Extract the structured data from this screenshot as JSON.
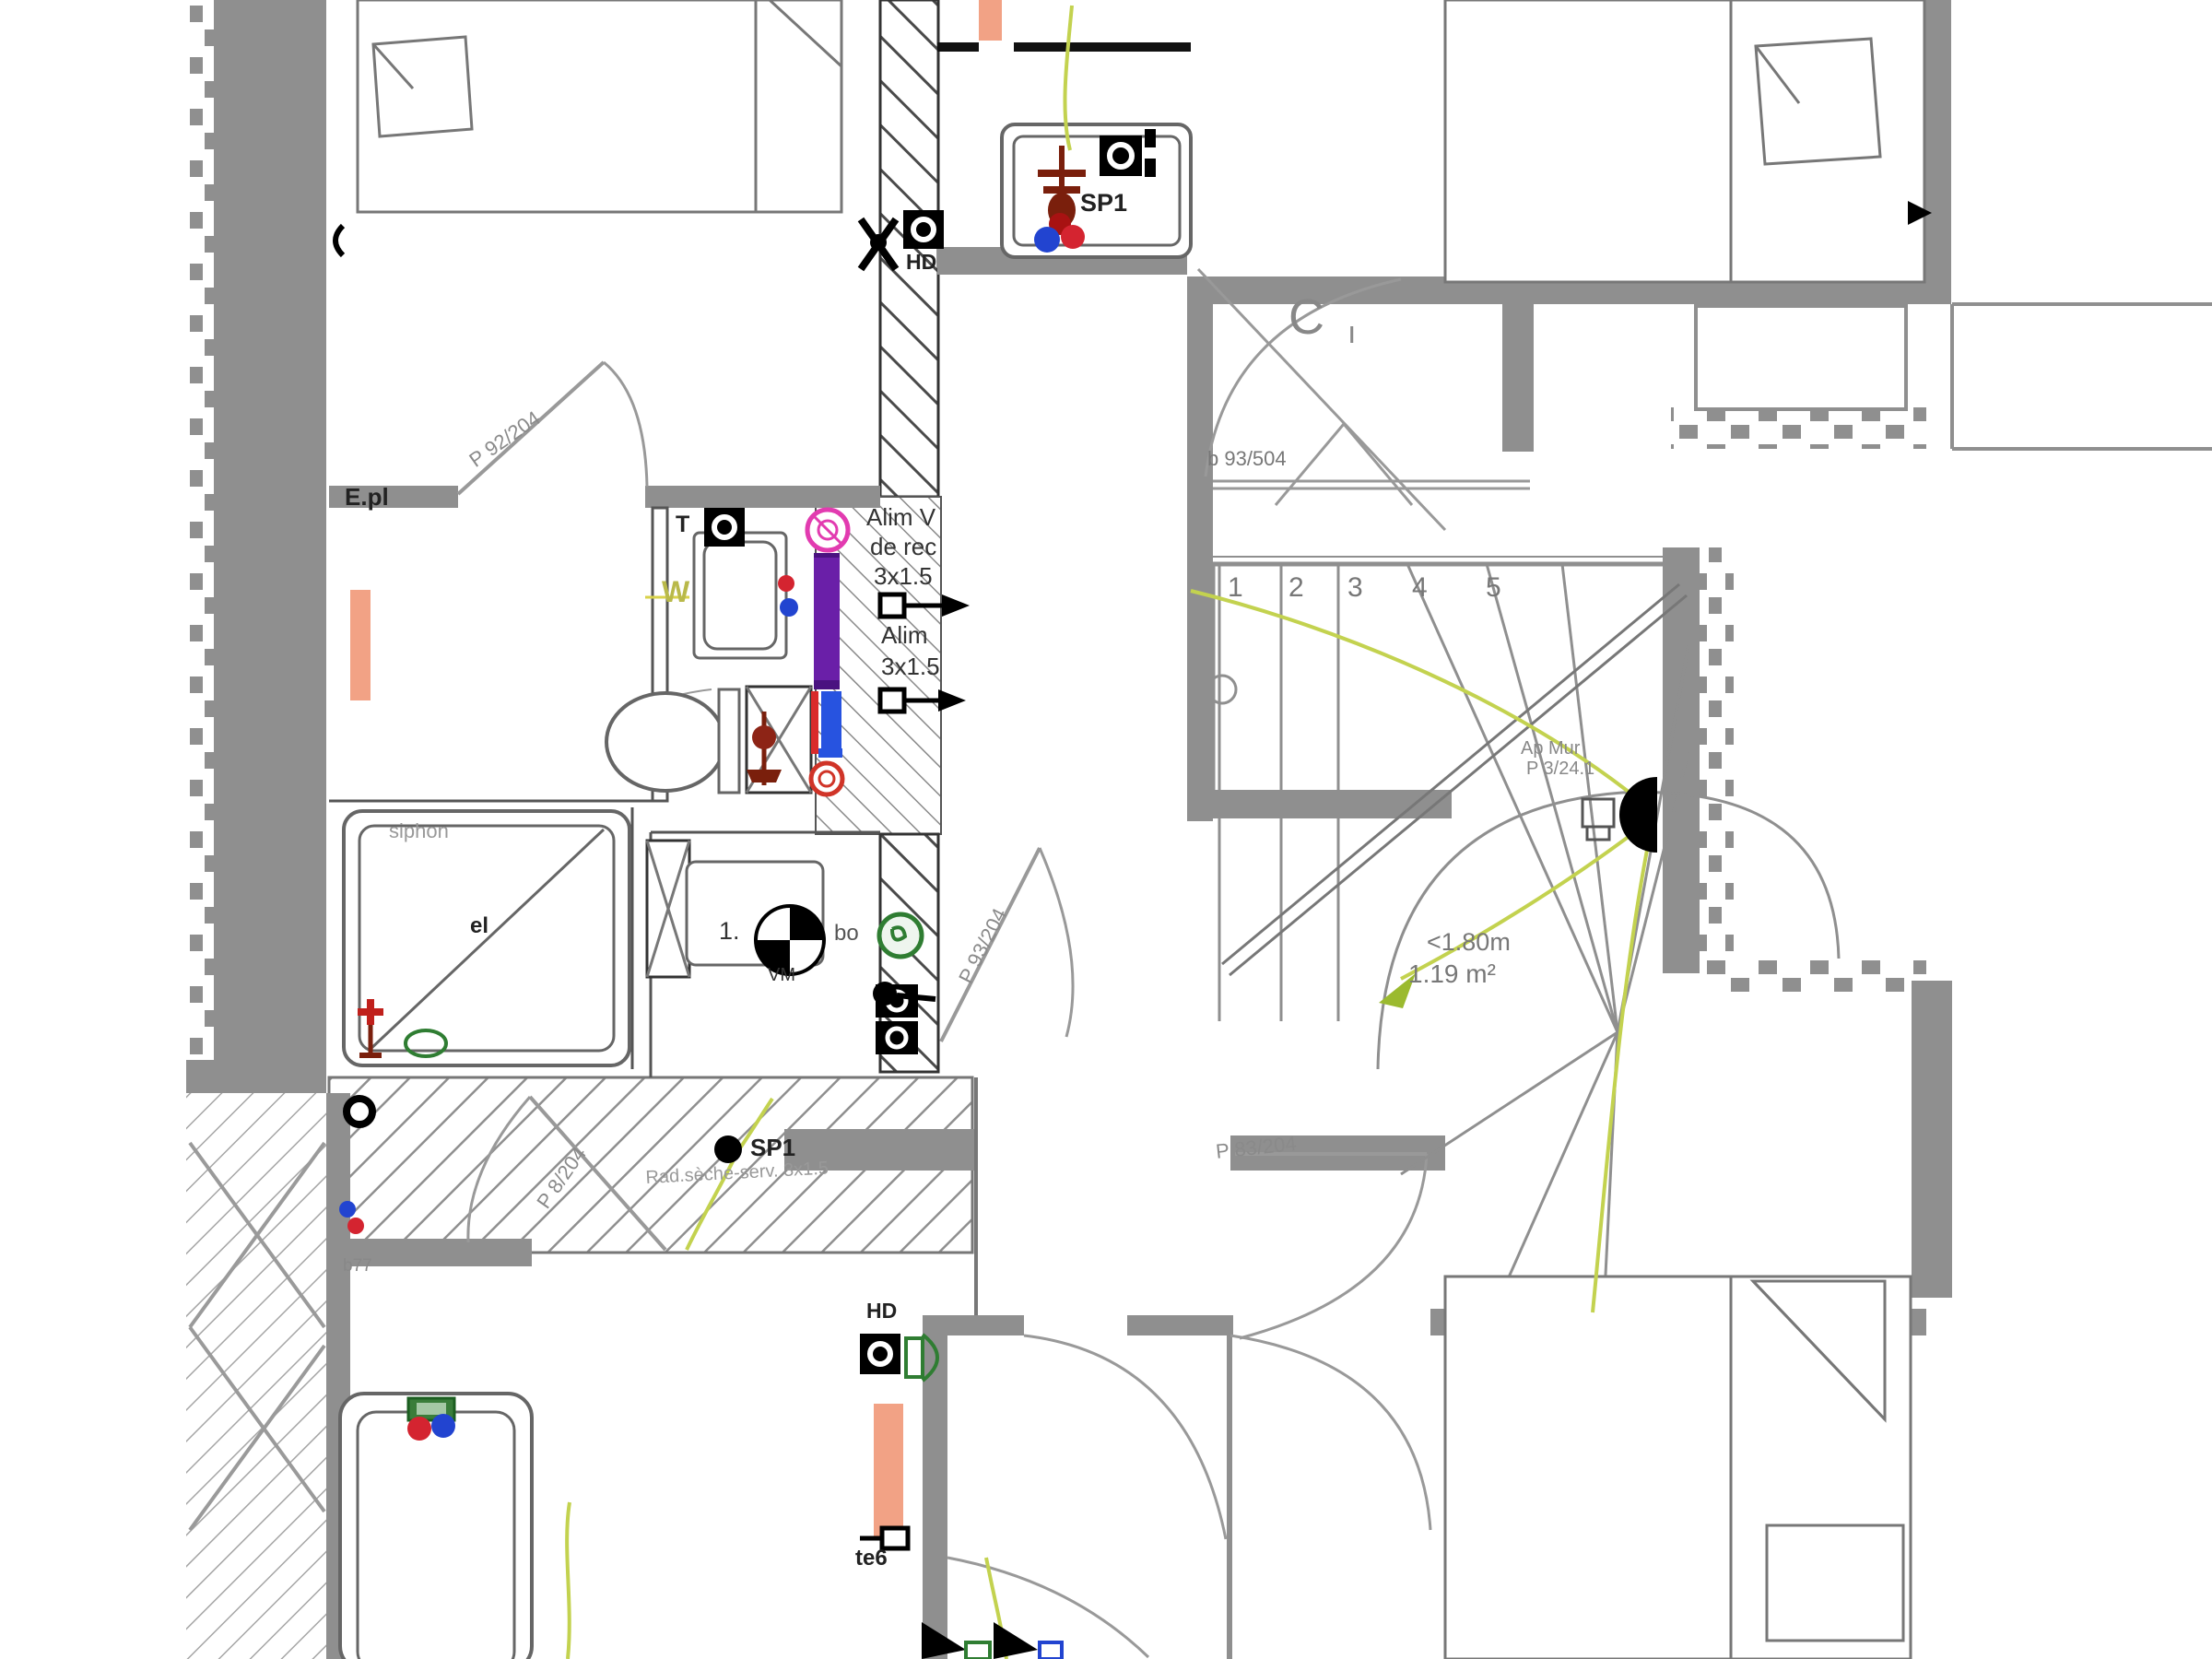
{
  "colors": {
    "wall": "#8f8f8f",
    "thin": "#6f6f6f",
    "line": "#9a9a9a",
    "radiator": "#f2a285",
    "cable": "#c3d24f",
    "purple": "#6a1fa8",
    "bluepipe": "#2753e0",
    "redpipe": "#d92b2b",
    "hot": "#d42430",
    "cold": "#2244d0",
    "magenta": "#e23bb0",
    "darkred": "#7a1f0c",
    "green": "#2f7d32",
    "label": "#8a8a8a"
  },
  "texts": {
    "sp1_top": "SP1",
    "hd_top": "HD",
    "alim1_l1": "Alim V",
    "alim1_l2": "de rec",
    "alim1_l3": "3x1.5",
    "alim2_l1": "Alim",
    "alim2_l2": "3x1.5",
    "epl": "E.pl",
    "door_upper_left": "P 92/204",
    "door_bath": "P 8/204",
    "door_corridor": "P 93/204",
    "door_bedroom3": "P 83/204",
    "window_stairs": "b 93/504",
    "c_mark": "C",
    "i_mark": "ı",
    "siphon": "siphon",
    "drain_mark": "el",
    "tap_mark": "T",
    "w_mark": "W",
    "wall_light_l1": "Ap Mur",
    "wall_light_l2": "P 3/24.1",
    "stair_dim_l1": "<1.80m",
    "stair_dim_l2": "1.19 m²",
    "dcl_num": "1.",
    "dcl_vm": "VM",
    "dcl_bo": "bo",
    "sp1_bottom": "SP1",
    "rad_note": "Rad.sèche-serv. 3x1.5",
    "b77": "b77",
    "hd_bottom": "HD",
    "te6": "te6"
  },
  "stairs": {
    "numbers": [
      "1",
      "2",
      "3",
      "4",
      "5"
    ]
  }
}
